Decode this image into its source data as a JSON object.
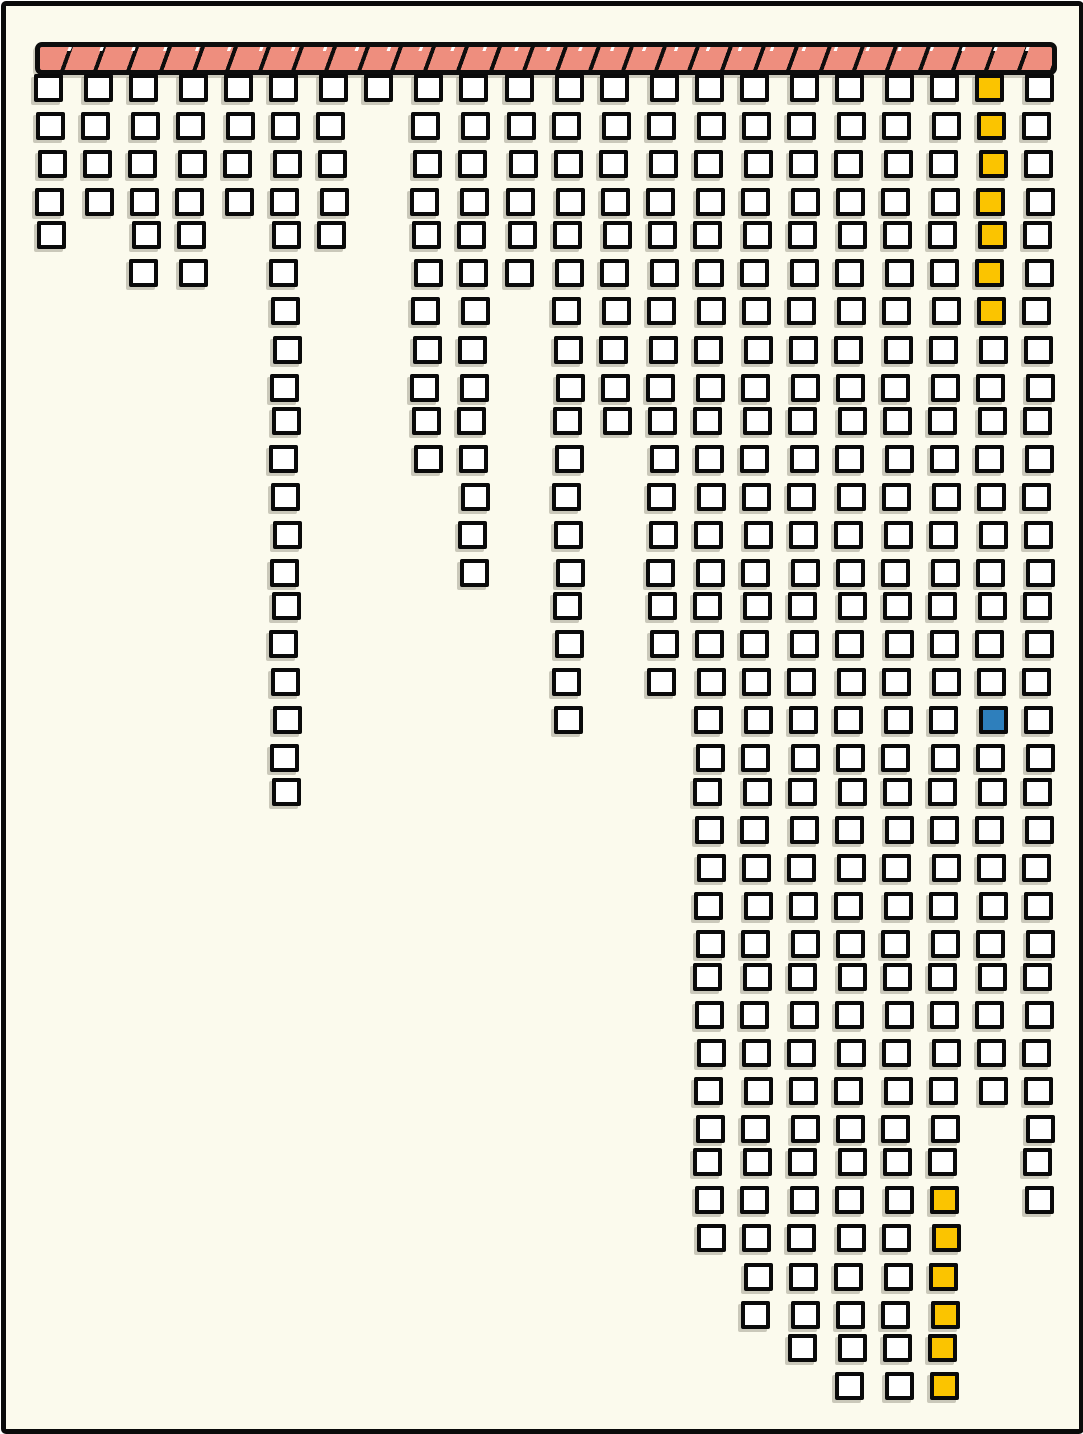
{
  "canvas": {
    "width_px": 1083,
    "height_px": 1433,
    "background_color": "#fbfaed",
    "frame_color": "#0a0a0a"
  },
  "top_bar": {
    "fill_color": "#ee8e7e",
    "stripe_color": "#0d0d0d",
    "segment_count": 30,
    "x": 35,
    "y": 42,
    "width": 1012,
    "height": 23
  },
  "layout": {
    "grid_x0": 36,
    "grid_y0": 75,
    "col_pitch": 47.05,
    "row_pitch": 37.08,
    "cell_w": 29,
    "cell_h": 28,
    "jitter": 2
  },
  "palette": {
    "square_fill": "#ffffff",
    "square_border": "#0a0a0a",
    "highlight_yellow": "#fbc400",
    "highlight_blue": "#2e7fbc"
  },
  "chart_data": {
    "type": "bar",
    "style": "unit-square waffle columns hanging downward from a striped horizontal bar (hand-drawn xkcd style, no text labels)",
    "title": "",
    "xlabel": "",
    "ylabel": "",
    "legend": [],
    "grid": false,
    "categories": [
      "1",
      "2",
      "3",
      "4",
      "5",
      "6",
      "7",
      "8",
      "9",
      "10",
      "11",
      "12",
      "13",
      "14",
      "15",
      "16",
      "17",
      "18",
      "19",
      "20",
      "21",
      "22"
    ],
    "values": [
      5,
      4,
      6,
      6,
      4,
      20,
      5,
      1,
      11,
      14,
      6,
      18,
      10,
      17,
      32,
      34,
      35,
      36,
      36,
      36,
      28,
      31
    ],
    "max_rows": 36,
    "total_squares": 395,
    "highlights": [
      {
        "column": 21,
        "row_from": 1,
        "row_to": 7,
        "color_key": "highlight_yellow",
        "count": 7
      },
      {
        "column": 21,
        "row_from": 18,
        "row_to": 18,
        "color_key": "highlight_blue",
        "count": 1
      },
      {
        "column": 20,
        "row_from": 31,
        "row_to": 36,
        "color_key": "highlight_yellow",
        "count": 6
      }
    ]
  }
}
